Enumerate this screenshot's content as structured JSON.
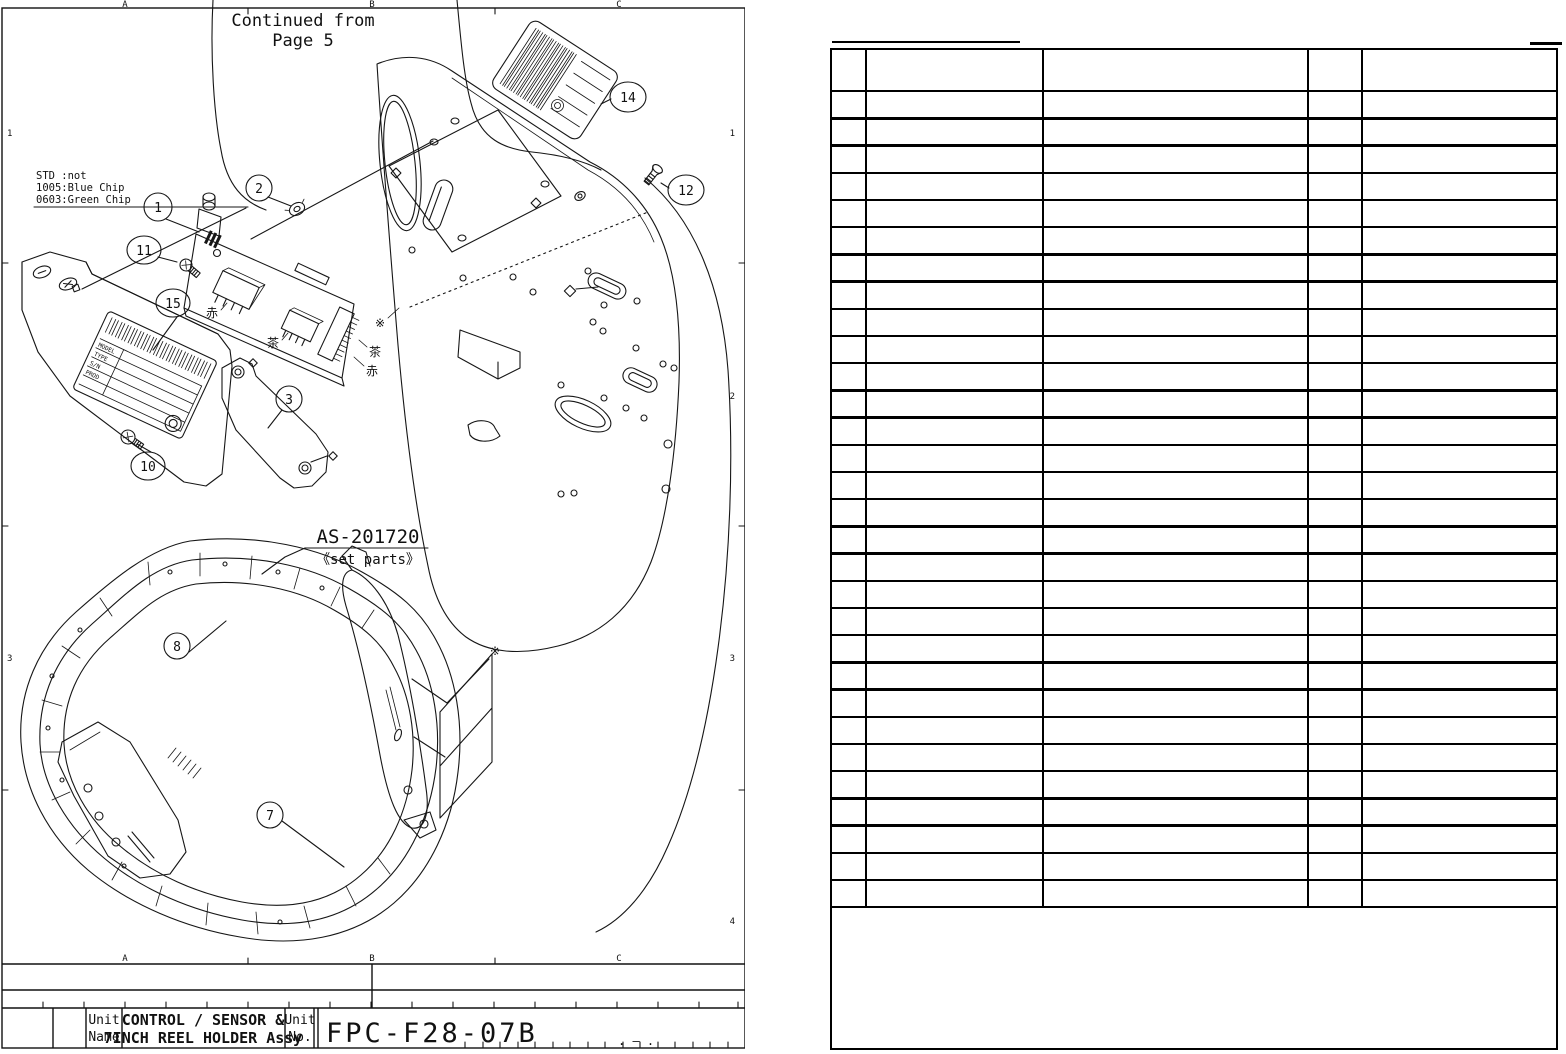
{
  "page": {
    "drawing": {
      "continued_note_line1": "Continued from",
      "continued_note_line2": "Page 5",
      "grid": {
        "col_labels": [
          "A",
          "B",
          "C"
        ],
        "row_labels": [
          "1",
          "2",
          "3",
          "4"
        ]
      },
      "chip_note_line1": "STD :not",
      "chip_note_line2": "1005:Blue Chip",
      "chip_note_line3": "0603:Green Chip",
      "set_parts_code": "AS-201720",
      "set_parts_caption": "《set parts》",
      "callout_labels": {
        "n1": "1",
        "n2": "2",
        "n3": "3",
        "n7": "7",
        "n8": "8",
        "n10": "10",
        "n11": "11",
        "n12": "12",
        "n14": "14",
        "n15": "15"
      },
      "wire_mark_red": "赤",
      "wire_mark_brown": "茶",
      "reference_mark": "※",
      "nameplate_rows": [
        "MODEL",
        "TYPE",
        "S/N",
        "PROD"
      ]
    },
    "title_block": {
      "unit_name_label_line1": "Unit",
      "unit_name_label_line2": "Name",
      "unit_name_line1": "CONTROL / SENSOR &",
      "unit_name_line2": "7INCH REEL HOLDER Assy",
      "unit_no_label_line1": "Unit",
      "unit_no_label_line2": "No.",
      "unit_no": "FPC-F28-07B",
      "unit_no_suffix": ". — ."
    },
    "parts_table": {
      "header_row_height": 40,
      "body_row_count": 30,
      "row_height": 27.2,
      "column_dividers_x": [
        33,
        210,
        475,
        529
      ]
    }
  }
}
